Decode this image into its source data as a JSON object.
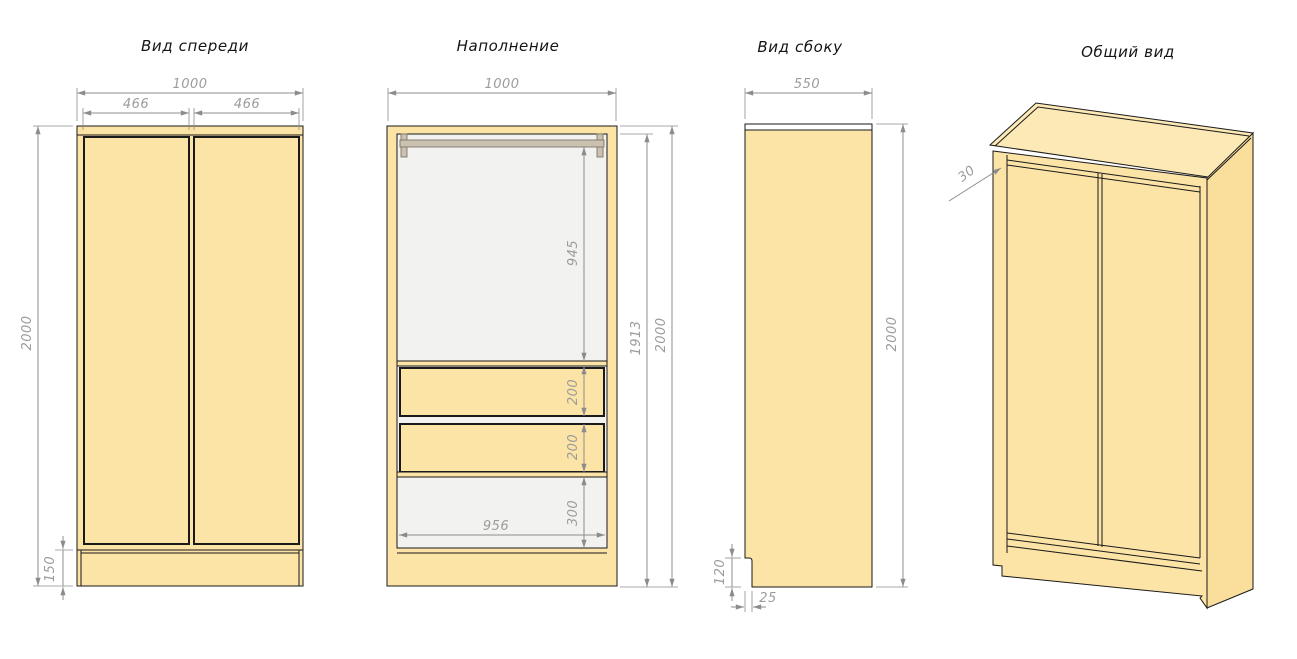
{
  "page": {
    "background": "#FFFFFF"
  },
  "colors": {
    "cabinet_fill": "#FCE3A6",
    "cabinet_top_fill": "#FCE9B6",
    "cabinet_side_fill": "#F9DE9C",
    "interior_fill": "#F2F2F0",
    "rod_fill": "#CAC1B0",
    "dimension_line": "#8C8C8C",
    "dimension_text": "#9C9C9C",
    "outline": "#1A1A1A"
  },
  "views": {
    "front": {
      "title": "Вид спереди",
      "dimensions": {
        "total_width": "1000",
        "left_door_width": "466",
        "right_door_width": "466",
        "total_height": "2000",
        "plinth_height": "150"
      }
    },
    "interior": {
      "title": "Наполнение",
      "dimensions": {
        "total_width": "1000",
        "hanging_space_height": "945",
        "carcass_inner_height": "1913",
        "total_height": "2000",
        "drawer_height_1": "200",
        "drawer_height_2": "200",
        "bottom_section_height": "300",
        "inner_width": "956"
      }
    },
    "side": {
      "title": "Вид сбоку",
      "dimensions": {
        "total_depth": "550",
        "total_height": "2000",
        "plinth_notch_height": "120",
        "plinth_notch_depth": "25"
      }
    },
    "overall": {
      "title": "Общий вид",
      "dimensions": {
        "top_panel_overhang": "30"
      }
    }
  }
}
